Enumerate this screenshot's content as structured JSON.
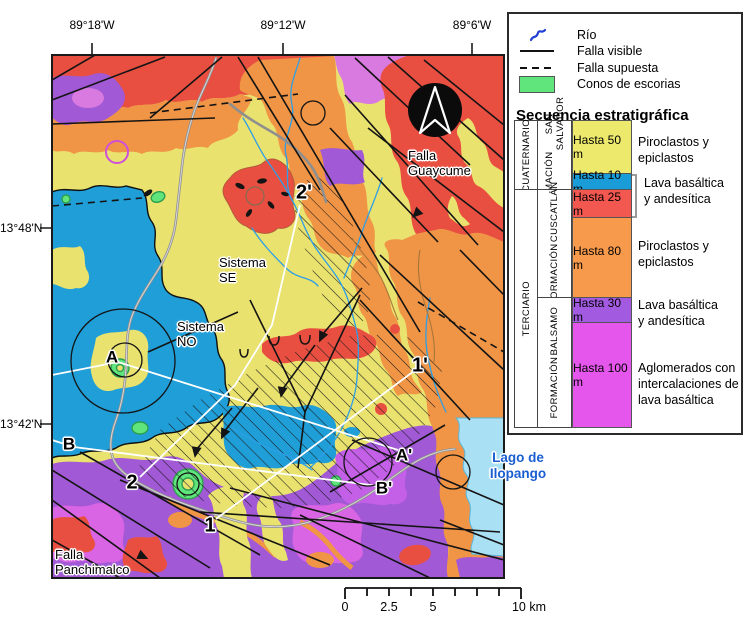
{
  "axis": {
    "top": [
      "89°18'W",
      "89°12'W",
      "89°6'W"
    ],
    "left": [
      "13°48'N",
      "13°42'N"
    ]
  },
  "map": {
    "labels": {
      "falla_guaycume": [
        "Falla",
        "Guaycume"
      ],
      "sistema_se": [
        "Sistema",
        "SE"
      ],
      "sistema_no": [
        "Sistema",
        "NO"
      ],
      "falla_panchimalco": [
        "Falla",
        "Panchimalco"
      ],
      "lago_de_ilopango": [
        "Lago de",
        "Ilopango"
      ]
    },
    "points": {
      "a": "A",
      "a_prime": "A'",
      "b": "B",
      "b_prime": "B'",
      "n1": "1",
      "n1_prime": "1'",
      "n2": "2",
      "n2_prime": "2'"
    }
  },
  "legend": {
    "symbols": [
      {
        "name": "rio",
        "label": "Río"
      },
      {
        "name": "falla-visible",
        "label": "Falla visible"
      },
      {
        "name": "falla-supuesta",
        "label": "Falla supuesta"
      },
      {
        "name": "conos-de-escorias",
        "label": "Conos de escorias"
      }
    ],
    "title": "Secuencia estratigráfica",
    "eras": [
      "CUATERNARIO",
      "TERCIARIO"
    ],
    "formations": [
      {
        "lines": [
          "FORMACIÓN",
          "SAN SALVADOR"
        ]
      },
      {
        "lines": [
          "FORMACIÓN",
          "CUSCATLÁN"
        ]
      },
      {
        "lines": [
          "FORMACIÓN",
          "BALSAMO"
        ]
      }
    ],
    "rows": [
      {
        "thickness": "Hasta 50 m",
        "color": "#ece96d",
        "desc": [
          "Piroclastos y",
          "epiclastos"
        ]
      },
      {
        "thickness": "Hasta 10 m",
        "color": "#199cd8"
      },
      {
        "thickness": "Hasta 25 m",
        "color": "#f25750"
      },
      {
        "thickness": "Hasta 80 m",
        "color": "#f79a4b",
        "desc": [
          "Piroclastos y",
          "epiclastos"
        ]
      },
      {
        "thickness": "Hasta 30 m",
        "color": "#a25be0",
        "desc": [
          "Lava basáltica",
          "y andesítica"
        ]
      },
      {
        "thickness": "Hasta 100 m",
        "color": "#e556ed",
        "desc": [
          "Aglomerados con",
          "intercalaciones de",
          "lava basáltica"
        ]
      }
    ],
    "shared_desc": [
      "Lava basáltica",
      "y andesítica"
    ]
  },
  "scalebar": {
    "labels": [
      "0",
      "2.5",
      "5",
      "10 km"
    ]
  },
  "colors": {
    "quaternary_yellow": "#e9e26e",
    "lava_blue": "#1f9ed8",
    "lava_red": "#e94f41",
    "cuscatlan_orange": "#f09445",
    "balsamo_purple": "#a159d6",
    "balsamo_magenta": "#d964e4",
    "cone_green": "#5fe57c",
    "lake_blue": "#a9e0f4",
    "river_blue": "#2e9fe6",
    "lake_label_blue": "#1a5ed2"
  }
}
